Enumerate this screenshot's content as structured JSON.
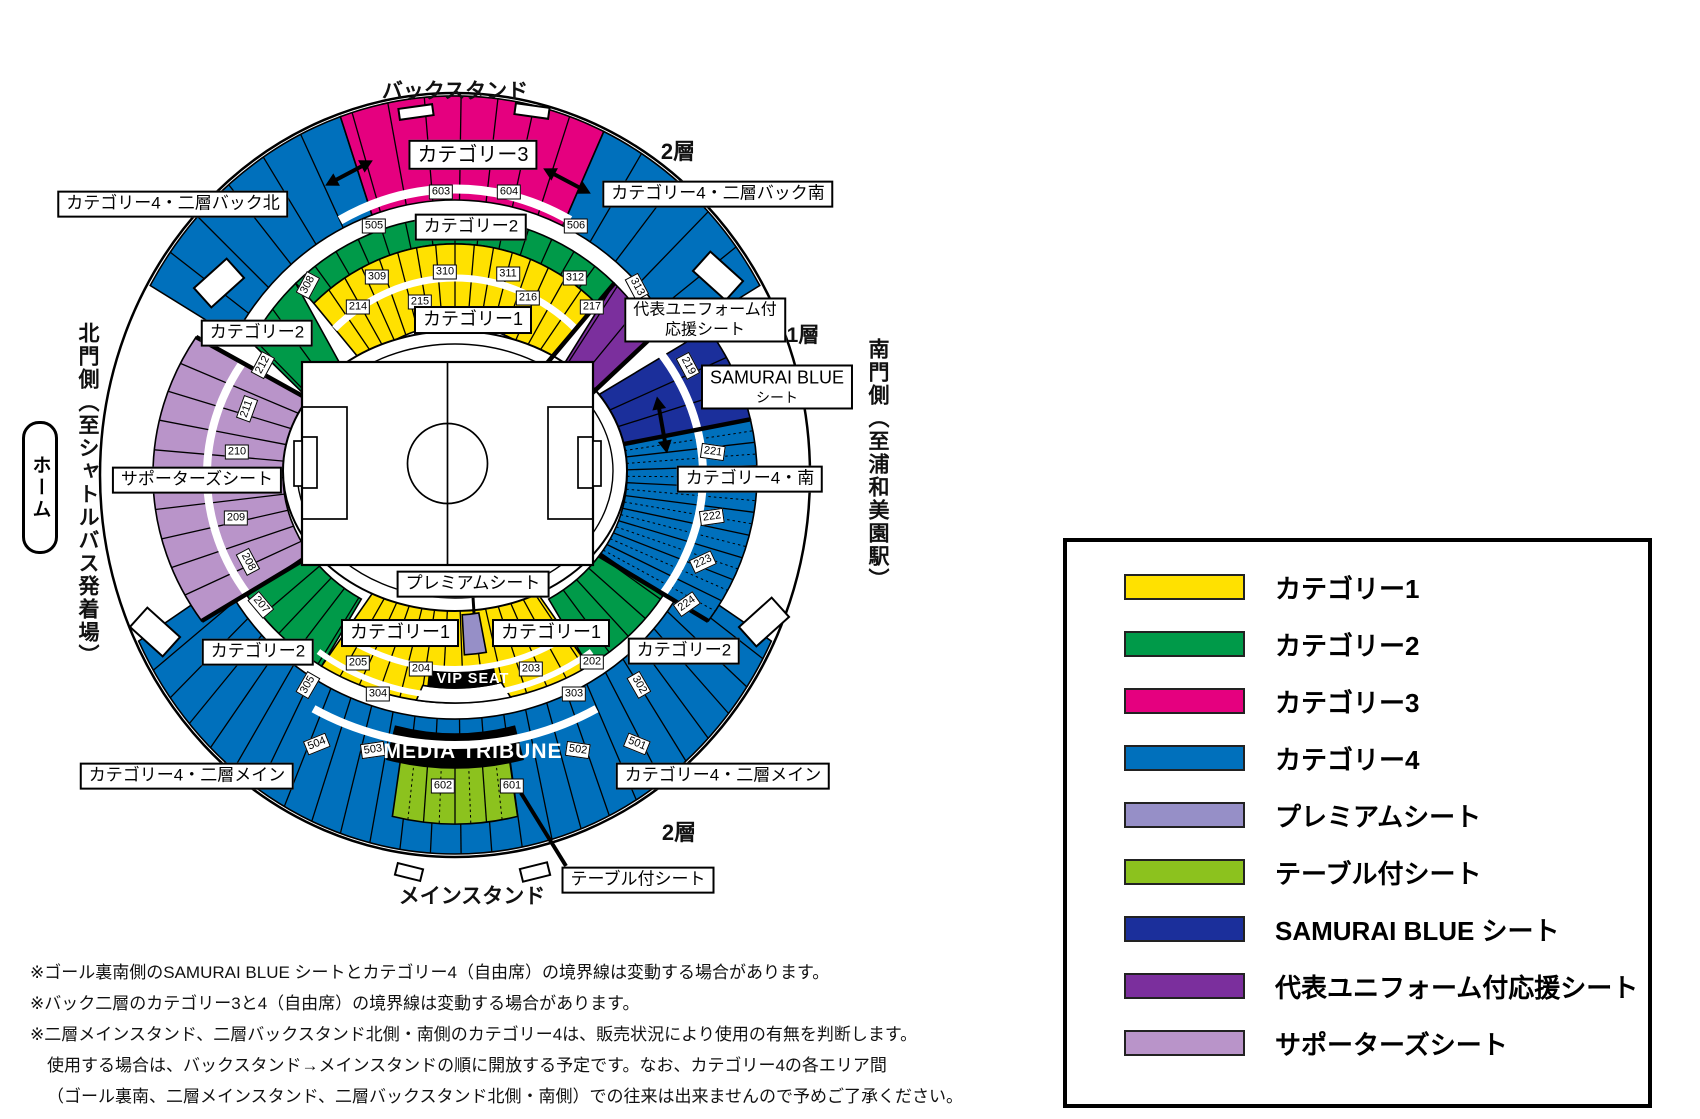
{
  "map": {
    "back_stand": "バックスタンド",
    "main_stand": "メインスタンド",
    "tier2_top": "2層",
    "tier2_bottom": "2層",
    "tier1": "1層",
    "home": "ホーム",
    "north_gate": "北門側（至シャトルバス発着場）",
    "south_gate": "南門側（至浦和美園駅）",
    "boxes": {
      "cat4_back_north": "カテゴリー4・二層バック北",
      "cat4_back_south": "カテゴリー4・二層バック南",
      "cat3": "カテゴリー3",
      "cat2_top": "カテゴリー2",
      "cat1_top": "カテゴリー1",
      "cat2_left": "カテゴリー2",
      "uniform_line1": "代表ユニフォーム付",
      "uniform_line2": "応援シート",
      "samurai_line1": "SAMURAI BLUE",
      "samurai_line2": "シート",
      "supporters": "サポーターズシート",
      "cat4_south": "カテゴリー4・南",
      "premium": "プレミアムシート",
      "cat1_bottom_left": "カテゴリー1",
      "cat1_bottom_right": "カテゴリー1",
      "cat2_bottom_left": "カテゴリー2",
      "cat2_bottom_right": "カテゴリー2",
      "cat4_main_left": "カテゴリー4・二層メイン",
      "cat4_main_right": "カテゴリー4・二層メイン",
      "table_seat": "テーブル付シート",
      "vip": "VIP SEAT",
      "media": "MEDIA TRIBUNE"
    },
    "section_numbers": [
      "603",
      "604",
      "505",
      "506",
      "308",
      "309",
      "310",
      "311",
      "312",
      "313",
      "214",
      "215",
      "216",
      "217",
      "219",
      "221",
      "222",
      "223",
      "224",
      "212",
      "211",
      "210",
      "209",
      "208",
      "207",
      "205",
      "204",
      "203",
      "202",
      "305",
      "304",
      "303",
      "302",
      "504",
      "503",
      "502",
      "501",
      "602",
      "601"
    ]
  },
  "colors": {
    "cat1": "#ffe100",
    "cat2": "#009a49",
    "cat3": "#e5007f",
    "cat4": "#0070bc",
    "premium": "#968fc7",
    "table": "#8cc21e",
    "samurai": "#1b2f9b",
    "uniform": "#7b2f9d",
    "supporters": "#b994c9"
  },
  "legend": {
    "items": [
      {
        "label": "カテゴリー1",
        "color": "#ffe100"
      },
      {
        "label": "カテゴリー2",
        "color": "#009a49"
      },
      {
        "label": "カテゴリー3",
        "color": "#e5007f"
      },
      {
        "label": "カテゴリー4",
        "color": "#0070bc"
      },
      {
        "label": "プレミアムシート",
        "color": "#968fc7"
      },
      {
        "label": "テーブル付シート",
        "color": "#8cc21e"
      },
      {
        "label": "SAMURAI BLUE シート",
        "color": "#1b2f9b"
      },
      {
        "label": "代表ユニフォーム付応援シート",
        "color": "#7b2f9d"
      },
      {
        "label": "サポーターズシート",
        "color": "#b994c9"
      }
    ]
  },
  "notes": {
    "lines": [
      "※ゴール裏南側のSAMURAI BLUE シートとカテゴリー4（自由席）の境界線は変動する場合があります。",
      "※バック二層のカテゴリー3と4（自由席）の境界線は変動する場合があります。",
      "※二層メインスタンド、二層バックスタンド北側・南側のカテゴリー4は、販売状況により使用の有無を判断します。",
      "使用する場合は、バックスタンド→メインスタンドの順に開放する予定です。なお、カテゴリー4の各エリア間",
      "（ゴール裏南、二層メインスタンド、二層バックスタンド北側・南側）での往来は出来ませんので予めご了承ください。"
    ]
  }
}
